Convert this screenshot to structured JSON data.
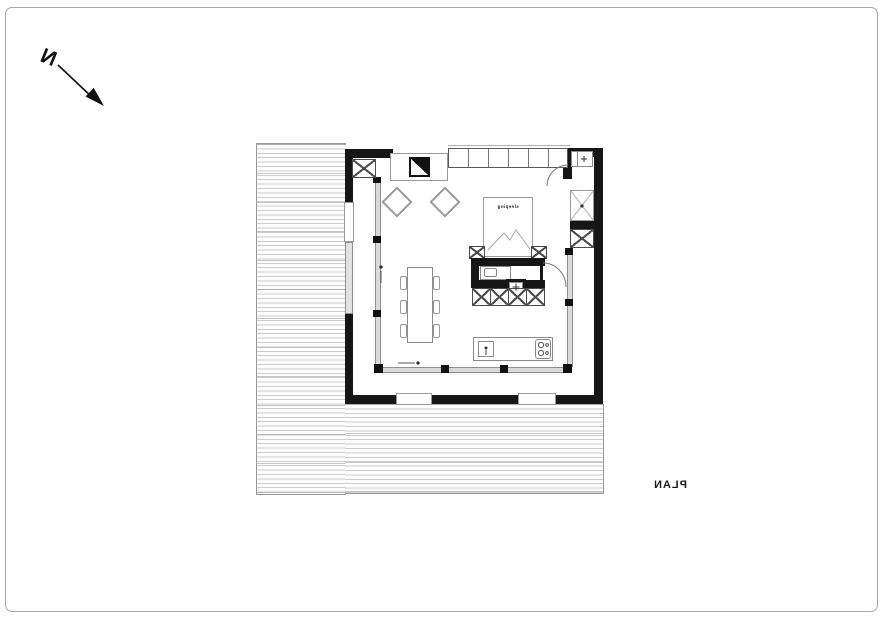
{
  "page": {
    "background": "#ffffff",
    "frame_color": "#a8a8a8"
  },
  "north": {
    "label": "N",
    "direction_note": "arrow pointing to lower-right, mirrored lettering"
  },
  "title": {
    "label": "PLAN",
    "mirrored": true
  },
  "plan": {
    "bed": {
      "label": "sleeping"
    },
    "colors": {
      "wall": "#161616",
      "line_dark": "#4a4a4a",
      "line_mid": "#8a8a8a",
      "line_light": "#c4c4c4",
      "deck_line": "#cdcdcd",
      "glazing_fill": "#d9d9d9"
    },
    "elements": [
      "wood-deck-left",
      "wood-deck-bottom",
      "exterior-walls",
      "glazed-facade",
      "fireplace",
      "lounge-chair",
      "lounge-chair",
      "dining-table",
      "dining-chairs",
      "bed",
      "nightstand",
      "nightstand",
      "bathroom",
      "bathroom-counter",
      "bathroom-sink",
      "wc-toilet",
      "shower-floor",
      "storage-cells",
      "wardrobe",
      "kitchen-island",
      "island-sink",
      "cooktop",
      "structural-column",
      "structural-column"
    ]
  }
}
